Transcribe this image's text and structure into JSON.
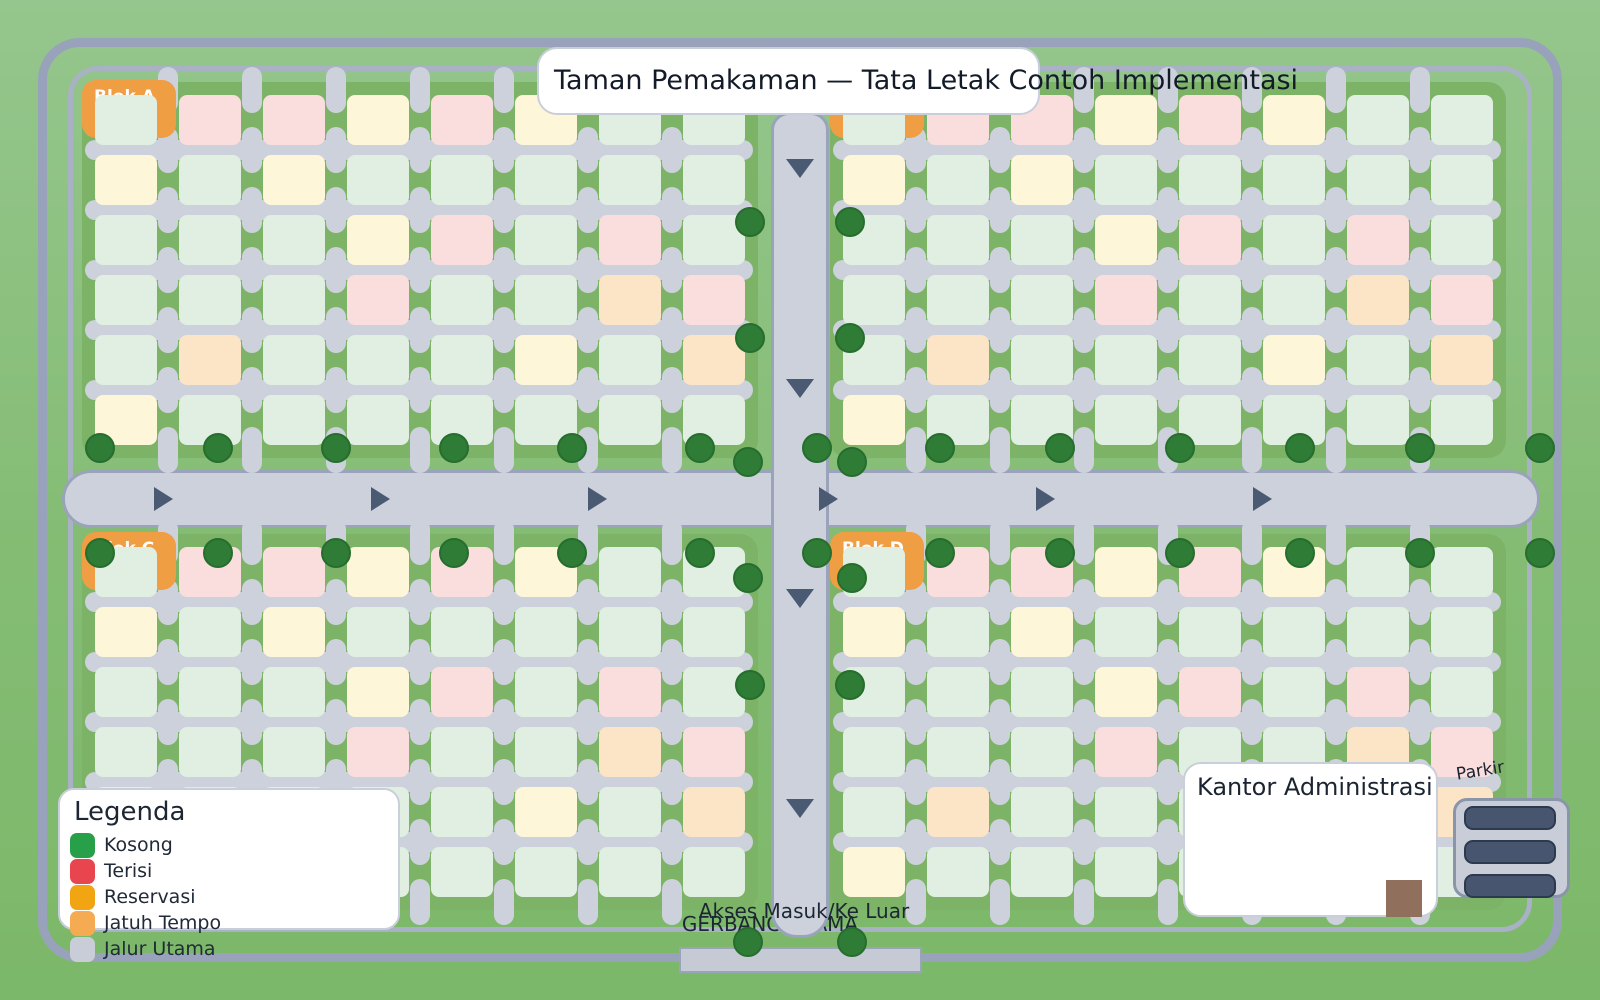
{
  "title": "Taman Pemakaman — Tata Letak Contoh Implementasi",
  "legend": {
    "title": "Legenda",
    "items": [
      {
        "label": "Kosong",
        "color": "#27a049"
      },
      {
        "label": "Terisi",
        "color": "#e8454f"
      },
      {
        "label": "Reservasi",
        "color": "#f2a512"
      },
      {
        "label": "Jatuh Tempo",
        "color": "#f5ab51"
      },
      {
        "label": "Jalur Utama",
        "color": "#c9cdd7"
      }
    ]
  },
  "blocks": [
    {
      "id": "A",
      "label": "Blok A",
      "position": "kiri-atas"
    },
    {
      "id": "B",
      "label": "Blok B",
      "position": "kanan-atas"
    },
    {
      "id": "C",
      "label": "Blok C",
      "position": "kiri-bawah"
    },
    {
      "id": "D",
      "label": "Blok D",
      "position": "kanan-bawah"
    }
  ],
  "plot_grid": {
    "rows": [
      "kttrtrkk",
      "rkrkkkkk",
      "kkkrtktk",
      "kkktkkjt",
      "kjkkkrkj",
      "rkkkkkkk"
    ],
    "codes": {
      "k": "kosong",
      "t": "terisi",
      "r": "reservasi",
      "j": "jatuh_tempo"
    },
    "fill_colors": {
      "kosong": "#e0efe1",
      "terisi": "#fadddd",
      "reservasi": "#fdf6d8",
      "jatuh_tempo": "#fce5c7"
    }
  },
  "landmarks": {
    "office": {
      "label": "Kantor Administrasi"
    },
    "parking": {
      "label": "Parkir",
      "spaces": 3
    },
    "gate": {
      "access_label": "Akses Masuk/Ke Luar",
      "gate_label": "GERBANG UTAMA"
    }
  },
  "map_colors": {
    "background_top": "#95c68d",
    "background_bottom": "#7cb869",
    "block_green": "#7cb366",
    "road": "#ccd1dc",
    "road_border": "#9aa3b9",
    "tree": "#2e7c35",
    "arrow": "#4a5a72",
    "block_label": "#f09e44",
    "outer_frame": "#98a2bb",
    "inner_frame": "#a9b1c5",
    "parking_bar": "#47566e",
    "office_door": "#906f5c"
  },
  "trees": [
    [
      100,
      448
    ],
    [
      218,
      448
    ],
    [
      336,
      448
    ],
    [
      454,
      448
    ],
    [
      572,
      448
    ],
    [
      700,
      448
    ],
    [
      817,
      448
    ],
    [
      940,
      448
    ],
    [
      1060,
      448
    ],
    [
      1180,
      448
    ],
    [
      1300,
      448
    ],
    [
      1420,
      448
    ],
    [
      1540,
      448
    ],
    [
      100,
      553
    ],
    [
      218,
      553
    ],
    [
      336,
      553
    ],
    [
      454,
      553
    ],
    [
      572,
      553
    ],
    [
      700,
      553
    ],
    [
      817,
      553
    ],
    [
      940,
      553
    ],
    [
      1060,
      553
    ],
    [
      1180,
      553
    ],
    [
      1300,
      553
    ],
    [
      1420,
      553
    ],
    [
      1540,
      553
    ],
    [
      748,
      462
    ],
    [
      852,
      462
    ],
    [
      748,
      578
    ],
    [
      852,
      578
    ],
    [
      750,
      222
    ],
    [
      850,
      222
    ],
    [
      750,
      338
    ],
    [
      850,
      338
    ],
    [
      750,
      685
    ],
    [
      850,
      685
    ],
    [
      748,
      942
    ],
    [
      852,
      942
    ]
  ],
  "arrows": {
    "horizontal_x": [
      163,
      380,
      597,
      828,
      1045,
      1262
    ],
    "horizontal_y": 499,
    "vertical_y": [
      168,
      388,
      598,
      808
    ],
    "vertical_x": 800
  }
}
